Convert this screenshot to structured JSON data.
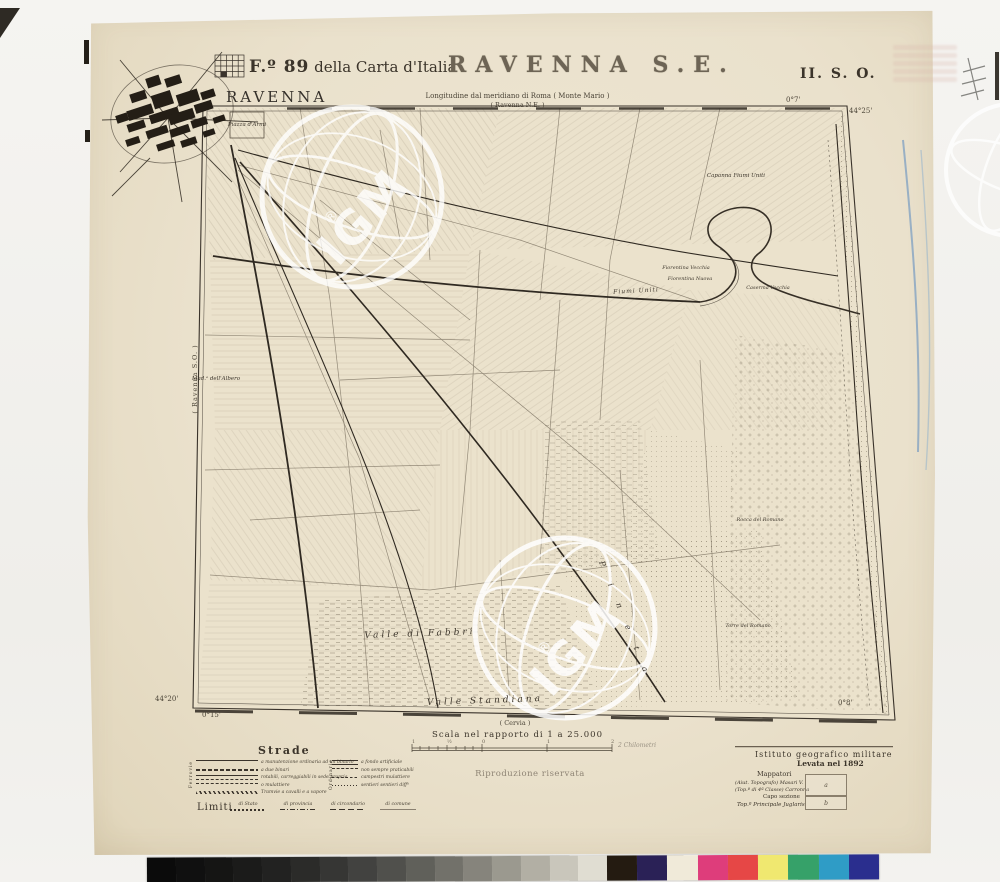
{
  "header": {
    "sheet_bold": "F.º 89",
    "sheet_rest": " della Carta d'Italia",
    "title": "RAVENNA S.E.",
    "quadrant": "II. S. O.",
    "longitude_note": "Longitudine dal meridiano di Roma ( Monte Mario )",
    "adjoining_ne": "( Ravenna N.E. )"
  },
  "graticule": {
    "top_lon": "0°7'",
    "ne_lat": "44°25'",
    "sw_lat": "44°20'",
    "sw_lon": "0°15'",
    "se_lon": "0°8'",
    "left_adjoining": "( Ravenna S.O. )",
    "bottom_adjoining": "( Cervia )"
  },
  "city_label": "RAVENNA",
  "map_labels": [
    {
      "t": "Piazza d'Armi",
      "x": 247,
      "y": 125,
      "s": 5.5,
      "r": 0,
      "sp": 0
    },
    {
      "t": "Mad.ᵃ dell'Albero",
      "x": 216,
      "y": 379,
      "s": 5.5,
      "r": 0,
      "sp": 0
    },
    {
      "t": "Capanna Fiumi Uniti",
      "x": 736,
      "y": 176,
      "s": 5.5,
      "r": 0,
      "sp": 0
    },
    {
      "t": "Fiorentina Vecchia",
      "x": 686,
      "y": 268,
      "s": 5,
      "r": 0,
      "sp": 0
    },
    {
      "t": "Fiorentina Nuova",
      "x": 690,
      "y": 279,
      "s": 5,
      "r": 0,
      "sp": 0
    },
    {
      "t": "Caserma Vecchia",
      "x": 768,
      "y": 288,
      "s": 5,
      "r": 0,
      "sp": 0
    },
    {
      "t": "Fiumi Uniti",
      "x": 636,
      "y": 291,
      "s": 6,
      "r": -3,
      "sp": 1
    },
    {
      "t": "Rocca del Romano",
      "x": 760,
      "y": 520,
      "s": 5,
      "r": 0,
      "sp": 0
    },
    {
      "t": "Torre del Romano",
      "x": 748,
      "y": 626,
      "s": 5,
      "r": 0,
      "sp": 0
    },
    {
      "t": "Valle  di  Fabbri",
      "x": 420,
      "y": 634,
      "s": 9,
      "r": -2,
      "sp": 3
    },
    {
      "t": "Valle  Standiana",
      "x": 485,
      "y": 701,
      "s": 9,
      "r": -2,
      "sp": 3
    },
    {
      "t": "P i n e t a",
      "x": 625,
      "y": 620,
      "s": 8,
      "r": 68,
      "sp": 8
    }
  ],
  "scale": {
    "caption": "Scala nel rapporto di 1 a 25.000",
    "unit_right": "2 Chilometri",
    "numbers": [
      {
        "t": "1",
        "x": 412
      },
      {
        "t": "½",
        "x": 447
      },
      {
        "t": "0",
        "x": 482
      },
      {
        "t": "1",
        "x": 547
      },
      {
        "t": "2",
        "x": 611
      }
    ]
  },
  "legend": {
    "strade_title": "Strade",
    "limiti_title": "Limiti",
    "ferrovie_label": "Ferrovie",
    "ordinarie_label": "Ordinarie",
    "left_items": [
      "a manutenzione ordinaria ad un binario",
      "a due binari",
      "rotabili, carreggiabili in sede propria",
      "o mulattiere",
      "Tramvie a cavalli e a vapore"
    ],
    "right_items": [
      "a fondo artificiale",
      "non sempre praticabili",
      "campestri   mulattiere",
      "sentieri   sentieri diffˡⁱ"
    ],
    "limiti_items": [
      "di Stato",
      "di provincia",
      "di circondario",
      "di comune"
    ]
  },
  "imprint": {
    "institute": "Istituto geografico militare",
    "survey": "Levata nel 1892",
    "surveyors_title": "Mappatori",
    "surveyor_a": "(Aiut. Topografo)  Masari V.",
    "surveyor_b": "(Top.º di 4ª Classe)  Carronna",
    "box_a": "a",
    "box_b": "b",
    "section_head_title": "Capo sezione",
    "section_head": "Top.º Principale  Juglaris"
  },
  "stamps": {
    "reproduction": "Riproduzione riservata"
  },
  "watermark": {
    "text": "IGM",
    "registered": "®"
  },
  "calibration": {
    "grays": [
      "#0b0b0b",
      "#101010",
      "#151514",
      "#1b1b1a",
      "#222221",
      "#2b2b29",
      "#363634",
      "#424240",
      "#50504c",
      "#60605a",
      "#72716a",
      "#86847c",
      "#9b998f",
      "#b2afa4",
      "#c9c6bb",
      "#e0ddd2"
    ],
    "colors": [
      "#241b11",
      "#2a2156",
      "#f0ead9",
      "#de3d7b",
      "#e64746",
      "#f0e870",
      "#36a169",
      "#2f9cc6",
      "#2a2e8e"
    ]
  }
}
